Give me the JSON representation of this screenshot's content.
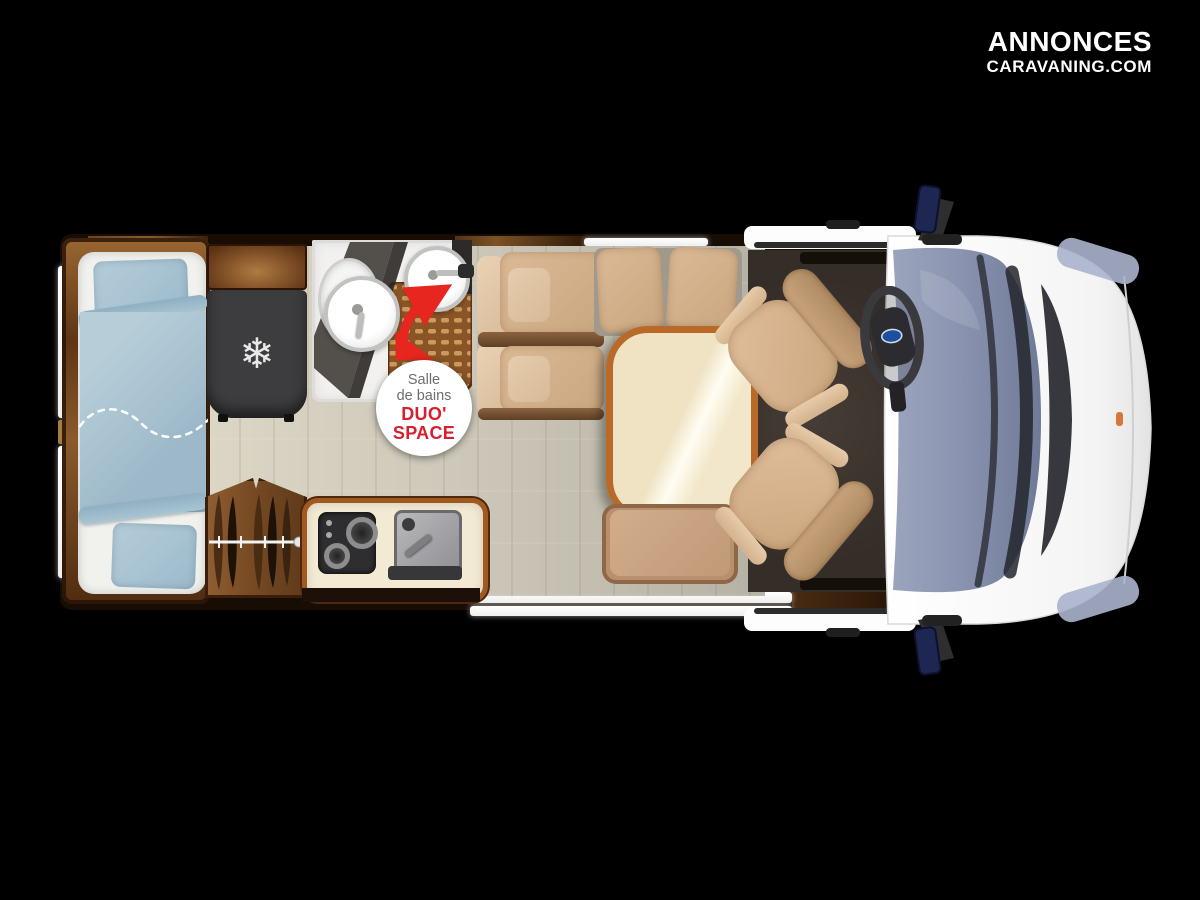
{
  "logo": {
    "line1": "ANNONCES",
    "line2": "CARAVANING.COM",
    "color": "#ffffff"
  },
  "bathroom_badge": {
    "line1": "Salle",
    "line2": "de bains",
    "line3": "DUO'",
    "line4": "SPACE",
    "label_color": "#6d6e71",
    "accent_color": "#d71f2f"
  },
  "icons": {
    "snowflake_glyph": "❄"
  },
  "palette": {
    "background": "#000000",
    "wall_brown": "#3a2312",
    "floor_wood": "#cdc8b9",
    "carpet_dark": "#3c332e",
    "duvet_blue": "#a9c3d2",
    "seat_beige": "#d7b493",
    "table_border": "#b96a28",
    "windshield_blue": "#8b96b1",
    "van_body_white": "#fbfbfb",
    "arrow_red": "#e6261f"
  }
}
